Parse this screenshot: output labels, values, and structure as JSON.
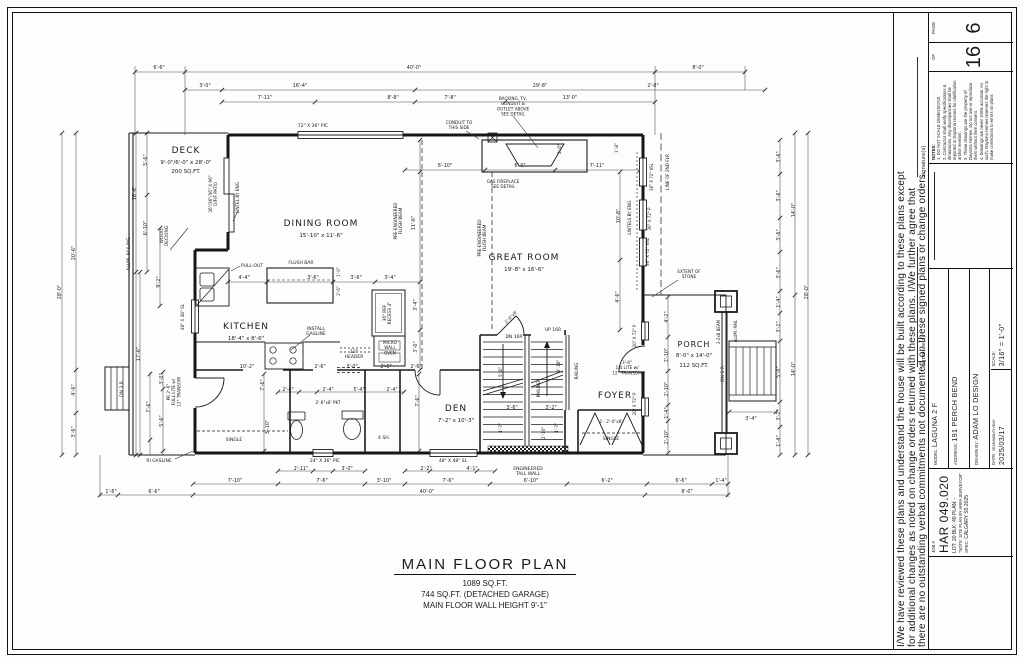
{
  "plan_title": {
    "title": "MAIN FLOOR PLAN",
    "sqft": "1089 SQ.FT.",
    "garage": "744 SQ.FT. (DETACHED GARAGE)",
    "wall_height": "MAIN FLOOR WALL HEIGHT 9'-1\""
  },
  "disclaimer": {
    "line1": "I/We have reviewed these plans and understand the house will be built according to these plans except",
    "line2": "for additional changes as noted on change orders returned with these plans. I/We further agree that",
    "line3": "there are no outstanding verbal commitments not documented on these signed plans or change orders.",
    "signature_label": "signature(s)"
  },
  "title_block": {
    "page_label": "PAGE",
    "page_number": "6",
    "of_label": "OF",
    "page_total": "16",
    "notes_title": "NOTES:",
    "notes": [
      "1. DO NOT SCALE DIMENSIONS",
      "2. Contractor shall verify specifications & dimensions. Any discrepancies shall be reported to Daytona Homes for clarification and/or revision.",
      "3. These drawings are the property of Daytona Homes. Do not use or reproduce them without their consent.",
      "4. Drawings are never 100% accurate. As such, Daytona Homes reserves the right to make corrections to errors on plans"
    ],
    "model_label": "MODEL:",
    "model": "LAGUNA 2 F",
    "address_label": "ADDRESS:",
    "address": "191 PERCH BEND",
    "drawn_by_label": "DRAWN BY:",
    "drawn_by": "ADAM LO DESIGN",
    "date_label": "DATE:",
    "date_sublabel": "YEAR/MONTH/DAY",
    "date": "2025/03/17",
    "scale_label": "SCALE:",
    "scale": "3/16\" = 1'-0\"",
    "job_label": "JOB #",
    "job_number": "HAR 049.020",
    "lot_line": "LOT: 20    BLK: 49    PLAN: -",
    "site_note": "\"NOTE: SITE PLAN BY AREA SURVEYOR\"",
    "spec_label": "SPEC:",
    "spec": "CALGARY S5 2025"
  },
  "plan_labels": [
    {
      "t": "DECK",
      "x": 186,
      "y": 153,
      "fs": 9,
      "ls": 1
    },
    {
      "t": "9'-0\"/6'-0\" x 28'-0\"",
      "x": 186,
      "y": 164,
      "fs": 5.5
    },
    {
      "t": "200 SQ.FT.",
      "x": 186,
      "y": 173,
      "fs": 5.5
    },
    {
      "t": "DINING ROOM",
      "x": 321,
      "y": 226,
      "fs": 9,
      "ls": 1
    },
    {
      "t": "15'-10\" x 11'-6\"",
      "x": 321,
      "y": 237,
      "fs": 5.5
    },
    {
      "t": "GREAT ROOM",
      "x": 524,
      "y": 260,
      "fs": 9,
      "ls": 1
    },
    {
      "t": "19'-8\" x 16'-6\"",
      "x": 524,
      "y": 271,
      "fs": 5.5
    },
    {
      "t": "KITCHEN",
      "x": 246,
      "y": 329,
      "fs": 9,
      "ls": 1
    },
    {
      "t": "18'-4\" x 8'-6\"",
      "x": 246,
      "y": 340,
      "fs": 5.5
    },
    {
      "t": "DEN",
      "x": 456,
      "y": 411,
      "fs": 9,
      "ls": 1
    },
    {
      "t": "7'-2\" x 10'-3\"",
      "x": 456,
      "y": 422,
      "fs": 5.5
    },
    {
      "t": "FOYER",
      "x": 615,
      "y": 398,
      "fs": 9,
      "ls": 1
    },
    {
      "t": "PORCH",
      "x": 694,
      "y": 347,
      "fs": 8,
      "ls": 1
    },
    {
      "t": "8'-0\" x 14'-0\"",
      "x": 694,
      "y": 357,
      "fs": 5.5
    },
    {
      "t": "112 SQ.FT.",
      "x": 694,
      "y": 367,
      "fs": 5.5
    },
    {
      "t": "ALUM. RAILING",
      "x": 130,
      "y": 254,
      "r": -90,
      "fs": 4.5
    },
    {
      "t": "WOOD\nDECKING",
      "x": 163,
      "y": 236,
      "r": -90,
      "fs": 4.5
    },
    {
      "t": "DN 3 R",
      "x": 123,
      "y": 389,
      "r": -90,
      "fs": 4.5
    },
    {
      "t": "36\"/36\"/36\" X 96\"\nO/F/F PATIO",
      "x": 212,
      "y": 194,
      "r": -90,
      "fs": 4.2
    },
    {
      "t": "LINTEL BY ENG.",
      "x": 239,
      "y": 197,
      "r": -90,
      "fs": 4.2
    },
    {
      "t": "PULL-OUT",
      "x": 252,
      "y": 267,
      "fs": 4.5
    },
    {
      "t": "FLUSH BAR",
      "x": 301,
      "y": 264,
      "fs": 4.5
    },
    {
      "t": "INSTALL\nGASLINE",
      "x": 316,
      "y": 330,
      "fs": 4.5
    },
    {
      "t": "12\"\nHEADER",
      "x": 354,
      "y": 353,
      "fs": 4.5
    },
    {
      "t": "36\" REF\nRECESS 4\"",
      "x": 386,
      "y": 313,
      "r": -90,
      "fs": 4.2
    },
    {
      "t": "MICRO\nWALL\nOVEN",
      "x": 390,
      "y": 344,
      "fs": 4.2
    },
    {
      "t": "PRE-ENGINEERED\nFLUSH BEAM",
      "x": 397,
      "y": 221,
      "r": -90,
      "fs": 4.2
    },
    {
      "t": "PRE-ENGINEERED\nFLUSH BEAM",
      "x": 481,
      "y": 238,
      "r": -90,
      "fs": 4.2
    },
    {
      "t": "CONDUIT TO\nTHIS SIDE",
      "x": 459,
      "y": 124,
      "fs": 4.2
    },
    {
      "t": "BACKING, TV,\nCONDUIT &\nOUTLET ABOVE\nSEE DETAIL",
      "x": 513,
      "y": 100,
      "fs": 4.2
    },
    {
      "t": "GAS FIREPLACE\nSEE DETAIL",
      "x": 503,
      "y": 183,
      "fs": 4.2
    },
    {
      "t": "LINTELS BY ENG.",
      "x": 631,
      "y": 217,
      "r": -90,
      "fs": 4.2
    },
    {
      "t": "36\" X 72\" VSL",
      "x": 653,
      "y": 177,
      "r": -90,
      "fs": 4
    },
    {
      "t": "36\" X 72\" P",
      "x": 651,
      "y": 219,
      "r": -90,
      "fs": 4
    },
    {
      "t": "36\" X 72\" VSL",
      "x": 649,
      "y": 252,
      "r": -90,
      "fs": 4
    },
    {
      "t": "LINE OF 2ND FLR",
      "x": 669,
      "y": 172,
      "r": -90,
      "fs": 4.2
    },
    {
      "t": "EXTENT OF\nSTONE",
      "x": 689,
      "y": 273,
      "fs": 4.2
    },
    {
      "t": "3-2x8 BEAM",
      "x": 720,
      "y": 332,
      "r": -90,
      "fs": 4
    },
    {
      "t": "ALUM. RAIL",
      "x": 737,
      "y": 331,
      "r": -90,
      "fs": 4
    },
    {
      "t": "DN 5 R",
      "x": 724,
      "y": 374,
      "r": -90,
      "fs": 4.5
    },
    {
      "t": "DN 16R",
      "x": 514,
      "y": 338,
      "fs": 4.5
    },
    {
      "t": "UP 16R",
      "x": 553,
      "y": 331,
      "fs": 4.5
    },
    {
      "t": "RAILING",
      "x": 540,
      "y": 389,
      "r": -90,
      "fs": 4.2
    },
    {
      "t": "RAILING",
      "x": 578,
      "y": 371,
      "r": -90,
      "fs": 4.2
    },
    {
      "t": "ENGINEERED\nTALL WALL",
      "x": 528,
      "y": 470,
      "fs": 4.5
    },
    {
      "t": "2'-6\"x8' PKT",
      "x": 328,
      "y": 404,
      "fs": 4.2
    },
    {
      "t": "4 SH.",
      "x": 384,
      "y": 439,
      "fs": 4.5
    },
    {
      "t": "SINGLE",
      "x": 234,
      "y": 441,
      "fs": 4.5
    },
    {
      "t": "SINGLE",
      "x": 611,
      "y": 440,
      "fs": 4.5
    },
    {
      "t": "2 - 2'-0\"x8'",
      "x": 611,
      "y": 423,
      "fs": 4.2
    },
    {
      "t": "3'-0\"\n1/4 LITE w/\n12\" TRANSOM",
      "x": 627,
      "y": 364,
      "fs": 4.2
    },
    {
      "t": "PR 2'-6\"\nFULL LITE w/\n12\" TRANSOM",
      "x": 170,
      "y": 392,
      "r": -90,
      "fs": 4.2
    },
    {
      "t": "RI GASLINE",
      "x": 159,
      "y": 462,
      "fs": 4.5
    },
    {
      "t": "48\" X 48\" SL",
      "x": 184,
      "y": 317,
      "r": -90,
      "fs": 4.2
    },
    {
      "t": "24\" X 36\" PIC",
      "x": 325,
      "y": 462,
      "fs": 4.5
    },
    {
      "t": "48\" X 48\" SL",
      "x": 453,
      "y": 462,
      "fs": 4.5
    },
    {
      "t": "72\" X 36\" PIC",
      "x": 313,
      "y": 127,
      "fs": 4.5
    },
    {
      "t": "20\" X 72\" P",
      "x": 636,
      "y": 336,
      "r": -90,
      "fs": 4
    },
    {
      "t": "20\" X 72\" P",
      "x": 636,
      "y": 404,
      "r": -90,
      "fs": 4
    },
    {
      "t": "2'-6\"x8'",
      "x": 512,
      "y": 318,
      "r": -46,
      "fs": 4.2
    },
    {
      "t": "6'-6\"",
      "x": 159,
      "y": 69
    },
    {
      "t": "40'-0\"",
      "x": 414,
      "y": 69
    },
    {
      "t": "8'-0\"",
      "x": 698,
      "y": 69
    },
    {
      "t": "3'-0\"",
      "x": 205,
      "y": 87
    },
    {
      "t": "16'-4\"",
      "x": 300,
      "y": 87
    },
    {
      "t": "29'-8\"",
      "x": 540,
      "y": 87
    },
    {
      "t": "2'-0\"",
      "x": 653,
      "y": 87
    },
    {
      "t": "7'-11\"",
      "x": 265,
      "y": 99
    },
    {
      "t": "8'-8\"",
      "x": 393,
      "y": 99
    },
    {
      "t": "7'-8\"",
      "x": 450,
      "y": 99
    },
    {
      "t": "13'-0\"",
      "x": 570,
      "y": 99
    },
    {
      "t": "28'-0\"",
      "x": 61,
      "y": 292,
      "r": -90
    },
    {
      "t": "20'-6\"",
      "x": 75,
      "y": 253,
      "r": -90
    },
    {
      "t": "4'-6\"",
      "x": 75,
      "y": 390,
      "r": -90
    },
    {
      "t": "3'-6\"",
      "x": 75,
      "y": 432,
      "r": -90
    },
    {
      "t": "16'-6\"",
      "x": 136,
      "y": 193,
      "r": -90
    },
    {
      "t": "5'-6\"",
      "x": 147,
      "y": 160,
      "r": -90
    },
    {
      "t": "6'-10\"",
      "x": 147,
      "y": 228,
      "r": -90
    },
    {
      "t": "9'-2\"",
      "x": 160,
      "y": 282,
      "r": -90
    },
    {
      "t": "17'-6\"",
      "x": 140,
      "y": 354,
      "r": -90
    },
    {
      "t": "7'-6\"",
      "x": 150,
      "y": 407,
      "r": -90
    },
    {
      "t": "3'-0\"",
      "x": 163,
      "y": 379,
      "r": -90
    },
    {
      "t": "5'-6\"",
      "x": 163,
      "y": 421,
      "r": -90
    },
    {
      "t": "1'-6\"",
      "x": 111,
      "y": 493
    },
    {
      "t": "6'-6\"",
      "x": 154,
      "y": 493
    },
    {
      "t": "6'-10\"",
      "x": 445,
      "y": 167
    },
    {
      "t": "6'-0\"",
      "x": 520,
      "y": 167
    },
    {
      "t": "7'-11\"",
      "x": 597,
      "y": 167
    },
    {
      "t": "2'-0\"",
      "x": 561,
      "y": 149,
      "r": -90,
      "fs": 4.2
    },
    {
      "t": "1'-8\"",
      "x": 618,
      "y": 148,
      "r": -90,
      "fs": 4.2
    },
    {
      "t": "10'-8\"",
      "x": 620,
      "y": 216,
      "r": -90
    },
    {
      "t": "4'-6\"",
      "x": 619,
      "y": 297,
      "r": -90
    },
    {
      "t": "11'-6\"",
      "x": 415,
      "y": 223,
      "r": -90
    },
    {
      "t": "4'-4\"",
      "x": 244,
      "y": 279
    },
    {
      "t": "3'-6\"",
      "x": 313,
      "y": 279
    },
    {
      "t": "3'-6\"",
      "x": 356,
      "y": 279
    },
    {
      "t": "3'-4\"",
      "x": 390,
      "y": 279
    },
    {
      "t": "1'-0\"",
      "x": 340,
      "y": 272,
      "r": -90,
      "fs": 4
    },
    {
      "t": "2'-6\"",
      "x": 340,
      "y": 291,
      "r": -90,
      "fs": 4
    },
    {
      "t": "3'-4\"",
      "x": 417,
      "y": 305,
      "r": -90
    },
    {
      "t": "3'-0\"",
      "x": 417,
      "y": 347,
      "r": -90
    },
    {
      "t": "10'-2\"",
      "x": 247,
      "y": 368
    },
    {
      "t": "2'-6\"",
      "x": 320,
      "y": 368
    },
    {
      "t": "3'-0\"",
      "x": 352,
      "y": 368
    },
    {
      "t": "2'-6\"",
      "x": 386,
      "y": 368
    },
    {
      "t": "2'-6\"",
      "x": 416,
      "y": 368
    },
    {
      "t": "2'-4\"",
      "x": 288,
      "y": 391
    },
    {
      "t": "2'-4\"",
      "x": 328,
      "y": 391
    },
    {
      "t": "5'-4\"",
      "x": 359,
      "y": 391
    },
    {
      "t": "2'-4\"",
      "x": 392,
      "y": 391
    },
    {
      "t": "7'-6\"",
      "x": 264,
      "y": 385,
      "r": -90
    },
    {
      "t": "3'-10\"",
      "x": 269,
      "y": 427,
      "r": -90
    },
    {
      "t": "7'-6\"",
      "x": 419,
      "y": 401,
      "r": -90
    },
    {
      "t": "2'-11\"",
      "x": 301,
      "y": 470
    },
    {
      "t": "3'-0\"",
      "x": 347,
      "y": 470
    },
    {
      "t": "2'-2\"",
      "x": 426,
      "y": 470
    },
    {
      "t": "4'-1\"",
      "x": 472,
      "y": 470
    },
    {
      "t": "7'-10\"",
      "x": 235,
      "y": 482
    },
    {
      "t": "7'-6\"",
      "x": 322,
      "y": 482
    },
    {
      "t": "3'-10\"",
      "x": 384,
      "y": 482
    },
    {
      "t": "7'-6\"",
      "x": 448,
      "y": 482
    },
    {
      "t": "6'-10\"",
      "x": 531,
      "y": 482
    },
    {
      "t": "6'-2\"",
      "x": 607,
      "y": 482
    },
    {
      "t": "6'-6\"",
      "x": 681,
      "y": 482
    },
    {
      "t": "1'-4\"",
      "x": 721,
      "y": 482
    },
    {
      "t": "40'-0\"",
      "x": 427,
      "y": 493
    },
    {
      "t": "8'-0\"",
      "x": 687,
      "y": 493
    },
    {
      "t": "3'-6\"",
      "x": 512,
      "y": 409
    },
    {
      "t": "3'-2\"",
      "x": 551,
      "y": 409
    },
    {
      "t": "8'-10\"",
      "x": 560,
      "y": 366,
      "r": -90,
      "fs": 4.2
    },
    {
      "t": "5'-0\"",
      "x": 502,
      "y": 372,
      "r": -90,
      "fs": 4.2
    },
    {
      "t": "4'-7\"",
      "x": 502,
      "y": 428,
      "r": -90,
      "fs": 4.2
    },
    {
      "t": "4'-7\"",
      "x": 558,
      "y": 428,
      "r": -90,
      "fs": 4.2
    },
    {
      "t": "2'-10\"",
      "x": 545,
      "y": 433,
      "r": -90,
      "fs": 4
    },
    {
      "t": "4'-2\"",
      "x": 668,
      "y": 317,
      "r": -90
    },
    {
      "t": "2'-10\"",
      "x": 668,
      "y": 355,
      "r": -90
    },
    {
      "t": "2'-10\"",
      "x": 668,
      "y": 389,
      "r": -90
    },
    {
      "t": "1'-4\"",
      "x": 668,
      "y": 413,
      "r": -90
    },
    {
      "t": "2'-10\"",
      "x": 668,
      "y": 437,
      "r": -90
    },
    {
      "t": "3'-6\"",
      "x": 780,
      "y": 157,
      "r": -90
    },
    {
      "t": "3'-6\"",
      "x": 780,
      "y": 196,
      "r": -90
    },
    {
      "t": "3'-6\"",
      "x": 780,
      "y": 235,
      "r": -90
    },
    {
      "t": "3'-6\"",
      "x": 780,
      "y": 273,
      "r": -90
    },
    {
      "t": "1'-4\"",
      "x": 780,
      "y": 302,
      "r": -90
    },
    {
      "t": "3'-2\"",
      "x": 780,
      "y": 327,
      "r": -90
    },
    {
      "t": "5'-0\"",
      "x": 780,
      "y": 372,
      "r": -90
    },
    {
      "t": "3'-2\"",
      "x": 780,
      "y": 415,
      "r": -90
    },
    {
      "t": "1'-4\"",
      "x": 780,
      "y": 441,
      "r": -90
    },
    {
      "t": "14'-0\"",
      "x": 795,
      "y": 210,
      "r": -90
    },
    {
      "t": "14'-0\"",
      "x": 795,
      "y": 369,
      "r": -90
    },
    {
      "t": "28'-0\"",
      "x": 808,
      "y": 292,
      "r": -90
    },
    {
      "t": "3'-4\"",
      "x": 751,
      "y": 420
    }
  ]
}
